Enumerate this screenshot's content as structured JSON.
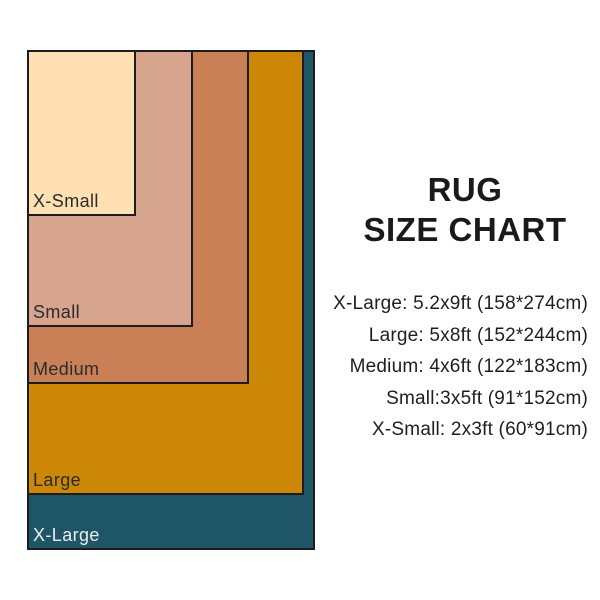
{
  "title": {
    "line1": "RUG",
    "line2": "SIZE CHART"
  },
  "legend": {
    "lines": [
      "X-Large: 5.2x9ft (158*274cm)",
      "Large: 5x8ft (152*244cm)",
      "Medium: 4x6ft (122*183cm)",
      "Small:3x5ft (91*152cm)",
      "X-Small: 2x3ft (60*91cm)"
    ]
  },
  "chart_data": {
    "type": "nested-rectangles",
    "title": "RUG SIZE CHART",
    "scale_px_per_cm": 1.823,
    "border_color": "#1c1c1c",
    "sizes": [
      {
        "name": "X-Small",
        "feet": "2x3ft",
        "cm": "60*91cm",
        "width_cm": 60,
        "height_cm": 91,
        "fill": "#fee0b2",
        "label_color": "#2b2b2b"
      },
      {
        "name": "Small",
        "feet": "3x5ft",
        "cm": "91*152cm",
        "width_cm": 91,
        "height_cm": 152,
        "fill": "#d7a48e",
        "label_color": "#2b2b2b"
      },
      {
        "name": "Medium",
        "feet": "4x6ft",
        "cm": "122*183cm",
        "width_cm": 122,
        "height_cm": 183,
        "fill": "#c98057",
        "label_color": "#2b2b2b"
      },
      {
        "name": "Large",
        "feet": "5x8ft",
        "cm": "152*244cm",
        "width_cm": 152,
        "height_cm": 244,
        "fill": "#cd8707",
        "label_color": "#2b2b2b"
      },
      {
        "name": "X-Large",
        "feet": "5.2x9ft",
        "cm": "158*274cm",
        "width_cm": 158,
        "height_cm": 274,
        "fill": "#1e5667",
        "label_color": "#e9edec"
      }
    ]
  }
}
